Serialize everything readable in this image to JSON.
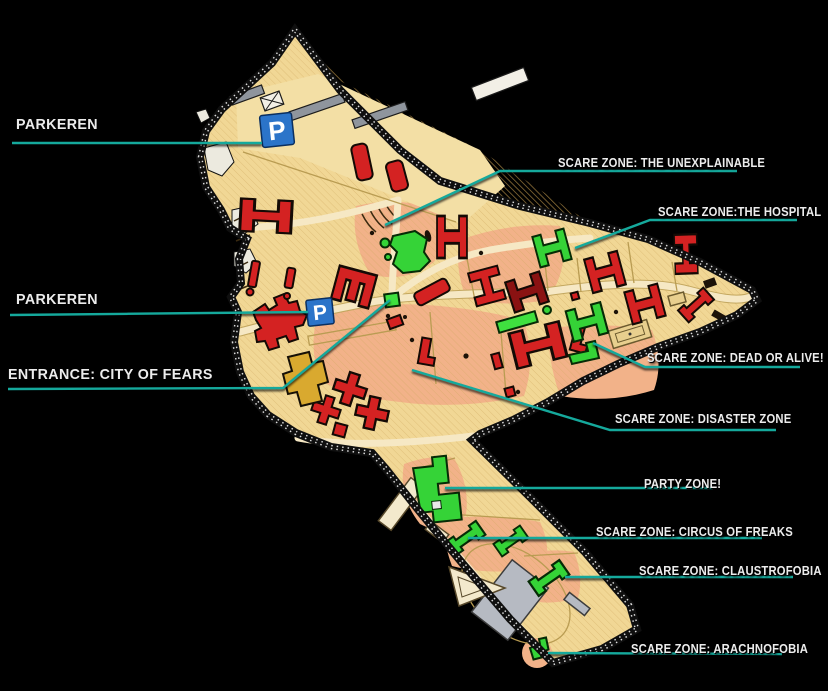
{
  "labels": {
    "parkeren_top": "PARKEREN",
    "scare_unexplainable": "SCARE ZONE: THE UNEXPLAINABLE",
    "scare_hospital": "SCARE ZONE:THE HOSPITAL",
    "parkeren_mid": "PARKEREN",
    "entrance": "ENTRANCE: CITY OF FEARS",
    "scare_dead_or_alive": "SCARE ZONE: DEAD OR ALIVE!",
    "scare_disaster": "SCARE ZONE: DISASTER ZONE",
    "party_zone": "PARTY ZONE!",
    "scare_circus": "SCARE ZONE: CIRCUS OF FREAKS",
    "scare_claustrofobia": "SCARE ZONE: CLAUSTROFOBIA",
    "scare_arachnofobia": "SCARE ZONE: ARACHNOFOBIA"
  },
  "map": {
    "parking_icon": "P",
    "colors": {
      "background": "#000000",
      "land": "#f1d795",
      "land_hatch": "#cfa85f",
      "scare_zone_salmon": "#f2b289",
      "building_red": "#d42222",
      "building_dark_red": "#8a1212",
      "building_green": "#35d337",
      "building_gray": "#b6bac2",
      "entrance_gold": "#d9a92f",
      "parking_blue": "#2b74c9",
      "leader_teal": "#15a99c",
      "label_text": "#ececec"
    }
  }
}
